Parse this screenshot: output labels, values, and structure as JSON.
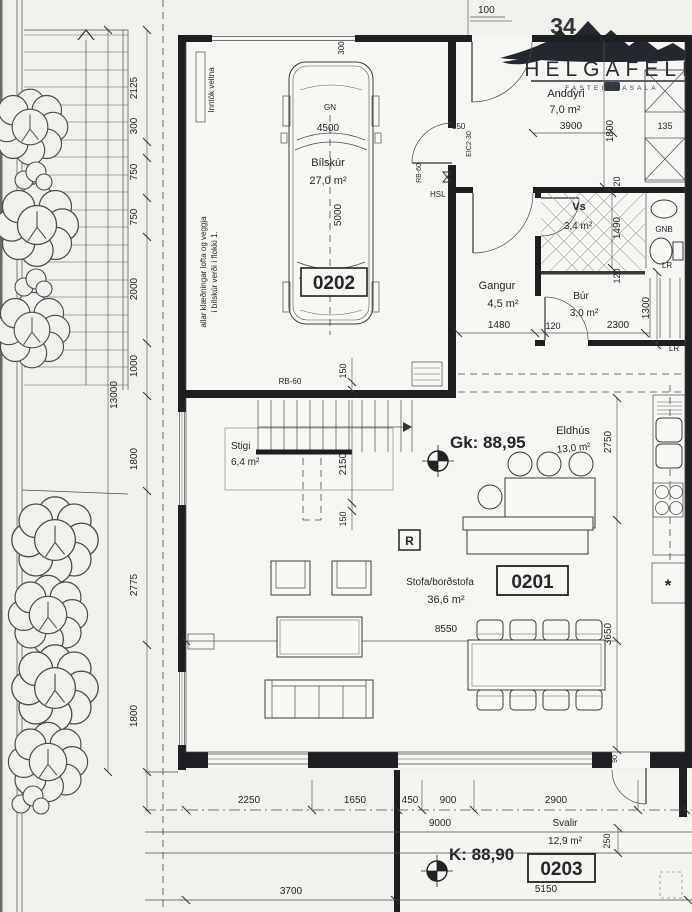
{
  "logo": {
    "brand": "HELGAFELL",
    "subtitle": "FASTEIGNASALA",
    "house_number": "34"
  },
  "levels": {
    "gk": "Gk: 88,95",
    "k": "K: 88,90"
  },
  "units": {
    "garage": "0202",
    "main": "0201",
    "balcony": "0203"
  },
  "rooms": {
    "anddyri": {
      "name": "Anddyri",
      "area": "7,0 m²"
    },
    "bilskur": {
      "name": "Bílskúr",
      "area": "27,0 m²"
    },
    "vs": {
      "name": "Vs",
      "area": "3,4 m²"
    },
    "gangur": {
      "name": "Gangur",
      "area": "4,5 m²"
    },
    "bur": {
      "name": "Búr",
      "area": "3,0 m²"
    },
    "stigi": {
      "name": "Stigi",
      "area": "6,4 m²"
    },
    "eldhus": {
      "name": "Eldhús",
      "area": "13,0 m²"
    },
    "stofa": {
      "name": "Stofa/borðstofa",
      "area": "36,6 m²"
    },
    "svalir": {
      "name": "Svalir",
      "area": "12,9 m²"
    }
  },
  "car": {
    "code": "GN",
    "length": "4500",
    "depth": "5000"
  },
  "notes": {
    "utilities": "Inntök veitna",
    "cladding1": "allar klæðningar lofta og veggja",
    "cladding2": "í bílskúr verði í flokki 1.",
    "rb60": "RB-60",
    "rb60b": "RB-60",
    "door_spec": "EIC2-30",
    "hsl": "HSL",
    "gnb": "GNB",
    "lr1": "LR",
    "lr2": "LR",
    "smoke": "R",
    "freezer": "*"
  },
  "dims": {
    "left": [
      "2125",
      "300",
      "750",
      "750",
      "2000",
      "1000",
      "1800",
      "2775",
      "1800"
    ],
    "left_total": "13000",
    "top100": "100",
    "top300": "300",
    "anddyri_w": "3900",
    "anddyri_h": "1800",
    "closet": "135",
    "entry": "150",
    "vs_h": "1490",
    "t120a": "120",
    "t120b": "120",
    "t120c": "120",
    "gangur_w": "1480",
    "bur_w": "2300",
    "bur_h": "1300",
    "wall150": "150",
    "stair_h": "2150",
    "stair150": "150",
    "kitchen_h": "2750",
    "dining_h": "3650",
    "stofa_w": "8550",
    "bottom": [
      "2250",
      "1650",
      "450",
      "900",
      "2900"
    ],
    "bottom_total": "9000",
    "terrace_w": "3700",
    "svalir_w": "5150",
    "svalir_d": "250",
    "door90": "90"
  }
}
